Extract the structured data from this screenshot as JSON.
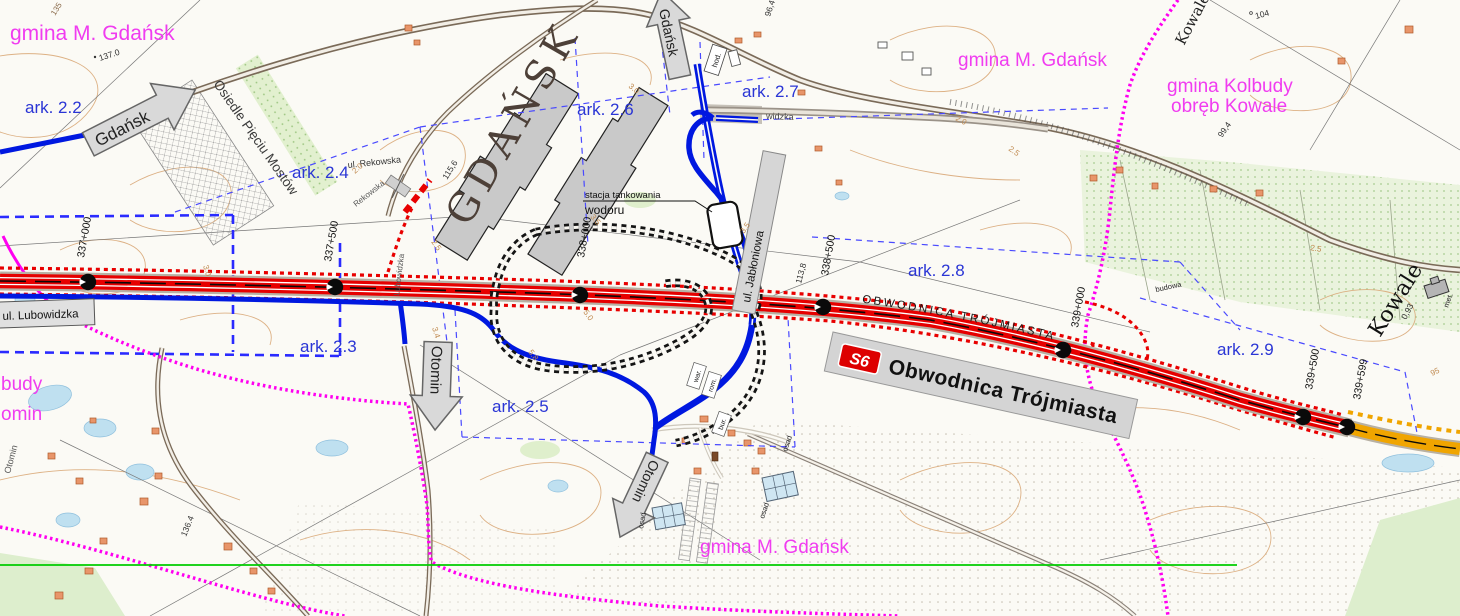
{
  "colors": {
    "planned_road": "#e60000",
    "secondary_road_blue": "#0018e0",
    "existing_road_brown": "#7a6a58",
    "boundary_magenta": "#ff00f0",
    "admin_text": "#f03cf0",
    "sheet_text": "#2a35d5",
    "arrow_fill": "#d9d9d9",
    "s6_badge_bg": "#dd0000",
    "end_section_road_orange": "#f0a500",
    "green_line": "#00cc00",
    "ramp_dotted_black": "#141414",
    "contour_tan": "#d9a878"
  },
  "admin": {
    "nw": "gmina M. Gdańsk",
    "ne": "gmina M. Gdańsk",
    "kolbudy_line1": "gmina Kolbudy",
    "kolbudy_line2": "obręb Kowale",
    "south": "gmina M. Gdańsk",
    "west_fragment_top": "budy",
    "west_fragment_bottom": "omin"
  },
  "sheets": {
    "s22": "ark. 2.2",
    "s23": "ark. 2.3",
    "s24": "ark. 2.4",
    "s25": "ark. 2.5",
    "s26": "ark. 2.6",
    "s27": "ark. 2.7",
    "s28": "ark. 2.8",
    "s29": "ark. 2.9"
  },
  "route": {
    "badge": "S6",
    "name": "Obwodnica Trójmiasta",
    "name_along": "OBWODNICA TRÓJMIASTA",
    "km_markers": {
      "k337000": "337+000",
      "k337500": "337+500",
      "k338000": "338+000",
      "k338500": "338+500",
      "k339000": "339+000",
      "k339500": "339+500",
      "k339599": "339+599"
    }
  },
  "arrows": {
    "gdansk_west": "Gdańsk",
    "gdansk_north": "Gdańsk",
    "otomin_mid": "Otomin",
    "otomin_south": "Otomin"
  },
  "streets": {
    "lubowidzka_box": "ul. Lubowidzka",
    "rekowska_label": "ul. Rekowska",
    "rekowska_along": "Rekowska",
    "lubowidzka_along": "Lubowidzka",
    "jabloniowa_box": "ul. Jabłoniowa",
    "widzka_fragment": "widzka",
    "osiedle": "Osiedle Pięciu Mostów",
    "gdansk_area": "GDAŃSK",
    "kowale_top": "Kowale",
    "kowale_right": "Kowale",
    "otomin_along": "Otomin"
  },
  "poi": {
    "hydrogen_station_line1": "stacja tankowania",
    "hydrogen_station_line2": "wodoru"
  },
  "small_labels": {
    "hod": "hod.",
    "war": "war.",
    "rom": "rom.",
    "bur": "bur.",
    "osad": "osad",
    "met": "met.",
    "budowa": "budowa"
  },
  "elevations": {
    "e135": "135",
    "e137_0": "137.0",
    "e115_6": "115,6",
    "e96_4": "96,4",
    "e104": "104",
    "e99_4": "99,4",
    "e113_8": "113,8",
    "e136_4": "136.4",
    "e0_93": "0,93",
    "e95": "95"
  },
  "measures": {
    "m2_0": "2.0",
    "m2_5": "2.5",
    "m3_0": "3.0",
    "m3_4": "3.4",
    "m3_5": "3.5",
    "m5_0": "5.0",
    "m5_8": "5.8"
  }
}
